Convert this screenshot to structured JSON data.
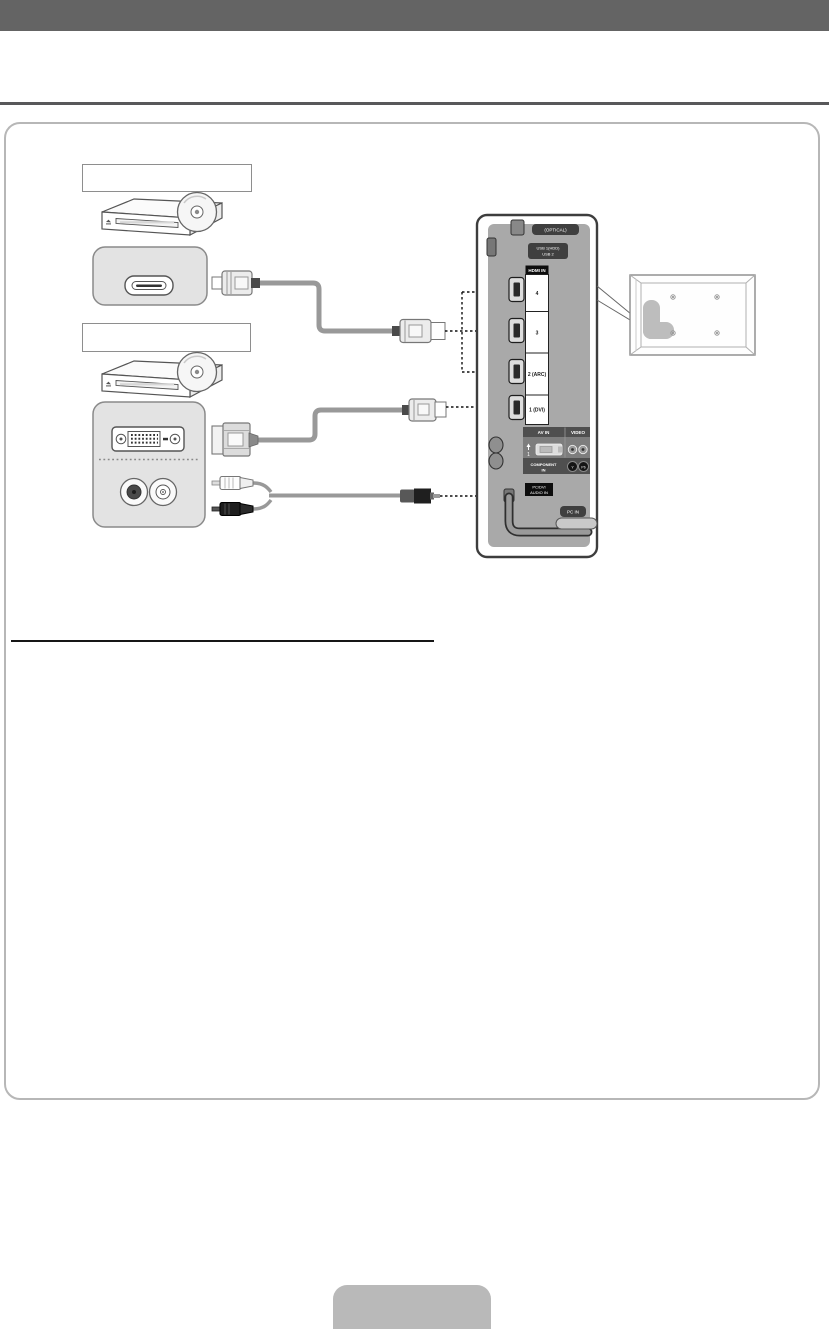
{
  "colors": {
    "banner": "#646464",
    "rule": "#58585a",
    "content_border": "#b7b7b7",
    "panel_body": "#a9a9a9",
    "dark_label": "#3f3f3f",
    "cable": "#999999",
    "arrow": "#111111",
    "footer_tab": "#b9b9b9"
  },
  "connection_diagram": {
    "device_labels": [
      {
        "label": ""
      },
      {
        "label": ""
      }
    ],
    "tv_panel": {
      "optical": "(OPTICAL)",
      "usb_line1": "USB 1(HDD)",
      "usb_line2": "USB 2",
      "hdmi": {
        "header": "HDMI IN",
        "ports": [
          "4",
          "3",
          "2 (ARC)",
          "1 (DVI)"
        ]
      },
      "av": {
        "av_in": "AV IN",
        "video": "VIDEO",
        "port_number": "1",
        "component_line1": "COMPONENT",
        "component_line2": "IN",
        "jack_y": "Y",
        "jack_pb": "Pb"
      },
      "pc_dvi_audio_line1": "PC/DVI",
      "pc_dvi_audio_line2": "AUDIO IN",
      "pc_in": "PC IN"
    },
    "icons": {
      "dvd_player": "dvd-player-illustration",
      "disc": "disc-icon",
      "hdmi_plug": "hdmi-plug-icon",
      "dvi_plug": "dvi-plug-icon",
      "rca_plug_white": "rca-plug-white-icon",
      "rca_plug_black": "rca-plug-black-icon",
      "stereo_plug": "stereo-plug-icon",
      "arrow": "arrow-right-icon"
    }
  }
}
